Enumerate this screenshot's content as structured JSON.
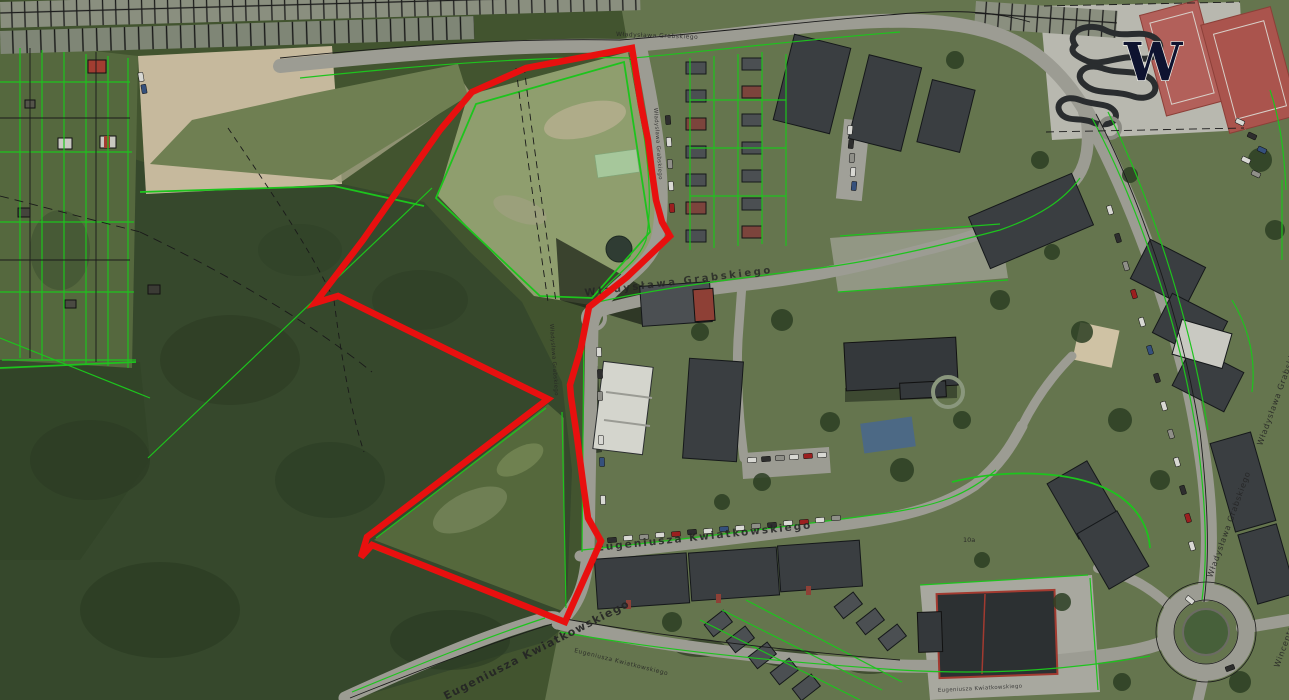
{
  "map": {
    "labels": {
      "grabskiego": "Władysława Grabskiego",
      "kwiatkowskiego": "Eugeniusza Kwiatkowskiego",
      "wincentego": "Wincentego",
      "w_monogram": "W",
      "building_10a": "10a"
    },
    "colors": {
      "selection_outline": "#e8100f",
      "parcel_line_green": "#1dc41d",
      "boundary_line_black": "#1a1a1a",
      "forest_green": "#36482c",
      "field_green": "#8f9e6e",
      "road_gray": "#9c9c93",
      "building_gray": "#3a3e41",
      "court_red": "#b2605a"
    }
  }
}
